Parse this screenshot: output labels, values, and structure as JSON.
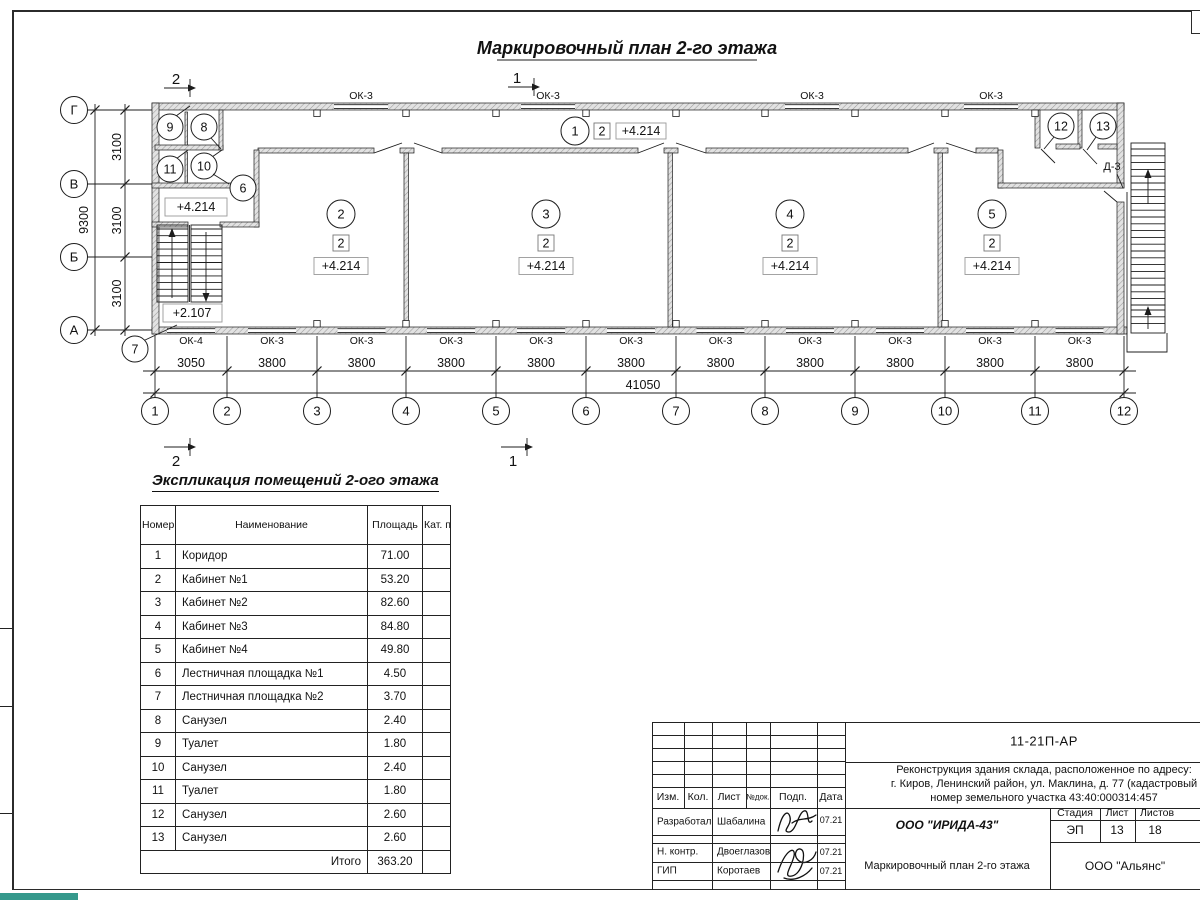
{
  "page": {
    "accent_teal": "#35998c",
    "line_color": "#1c1c1c"
  },
  "plan": {
    "title": "Маркировочный план 2-го этажа",
    "section_marks": {
      "top_left": "2",
      "top_right": "1",
      "bottom_left": "2",
      "bottom_right": "1"
    },
    "axes_bottom": [
      "1",
      "2",
      "3",
      "4",
      "5",
      "6",
      "7",
      "8",
      "9",
      "10",
      "11",
      "12"
    ],
    "axes_left": [
      "Г",
      "В",
      "Б",
      "А"
    ],
    "dims_bay": [
      "3050",
      "3800",
      "3800",
      "3800",
      "3800",
      "3800",
      "3800",
      "3800",
      "3800",
      "3800",
      "3800"
    ],
    "dim_total_bottom": "41050",
    "dims_left": [
      "3100",
      "3100",
      "3100"
    ],
    "dim_total_left": "9300",
    "windows_bottom": [
      "ОК-4",
      "ОК-3",
      "ОК-3",
      "ОК-3",
      "ОК-3",
      "ОК-3",
      "ОК-3",
      "ОК-3",
      "ОК-3",
      "ОК-3",
      "ОК-3"
    ],
    "windows_top": [
      "ОК-3",
      "ОК-3",
      "ОК-3",
      "ОК-3"
    ],
    "door_label": "Д-3",
    "main_rooms": [
      {
        "num": "1",
        "cat": "2",
        "elev": "+4.214"
      },
      {
        "num": "2",
        "cat": "2",
        "elev": "+4.214"
      },
      {
        "num": "3",
        "cat": "2",
        "elev": "+4.214"
      },
      {
        "num": "4",
        "cat": "2",
        "elev": "+4.214"
      },
      {
        "num": "5",
        "cat": "2",
        "elev": "+4.214"
      }
    ],
    "small_rooms": [
      "9",
      "8",
      "11",
      "10",
      "6",
      "7",
      "12",
      "13"
    ],
    "landing_elev": "+4.214",
    "stair_elev": "+2.107"
  },
  "table": {
    "title": "Экспликация помещений 2-ого этажа",
    "headers": [
      "Номер помещ.",
      "Наименование",
      "Площадь",
      "Кат. пом."
    ],
    "rows": [
      [
        "1",
        "Коридор",
        "71.00",
        ""
      ],
      [
        "2",
        "Кабинет №1",
        "53.20",
        ""
      ],
      [
        "3",
        "Кабинет №2",
        "82.60",
        ""
      ],
      [
        "4",
        "Кабинет №3",
        "84.80",
        ""
      ],
      [
        "5",
        "Кабинет №4",
        "49.80",
        ""
      ],
      [
        "6",
        "Лестничная площадка №1",
        "4.50",
        ""
      ],
      [
        "7",
        "Лестничная площадка №2",
        "3.70",
        ""
      ],
      [
        "8",
        "Санузел",
        "2.40",
        ""
      ],
      [
        "9",
        "Туалет",
        "1.80",
        ""
      ],
      [
        "10",
        "Санузел",
        "2.40",
        ""
      ],
      [
        "11",
        "Туалет",
        "1.80",
        ""
      ],
      [
        "12",
        "Санузел",
        "2.60",
        ""
      ],
      [
        "13",
        "Санузел",
        "2.60",
        ""
      ]
    ],
    "total_label": "Итого",
    "total_value": "363.20"
  },
  "title_block": {
    "doc_number": "11-21П-АР",
    "project_lines": [
      "Реконструкция здания склада, расположенное по адресу:",
      "г. Киров, Ленинский район, ул. Маклина, д. 77 (кадастровый",
      "номер земельного участка 43:40:000314:457"
    ],
    "rev_headers": [
      "Изм.",
      "Кол.",
      "Лист",
      "№док.",
      "Подп.",
      "Дата"
    ],
    "roles": [
      {
        "role": "Разработал",
        "name": "Шабалина",
        "date": "07.21"
      },
      {
        "role": "Н. контр.",
        "name": "Двоеглазов",
        "date": "07.21"
      },
      {
        "role": "ГИП",
        "name": "Коротаев",
        "date": "07.21"
      }
    ],
    "company": "ООО \"ИРИДА-43\"",
    "sheet_title": "Маркировочный план 2-го этажа",
    "stage_header": "Стадия",
    "sheet_header": "Лист",
    "sheets_header": "Листов",
    "stage": "ЭП",
    "sheet_number": "13",
    "sheets_total": "18",
    "contractor": "ООО \"Альянс\""
  }
}
